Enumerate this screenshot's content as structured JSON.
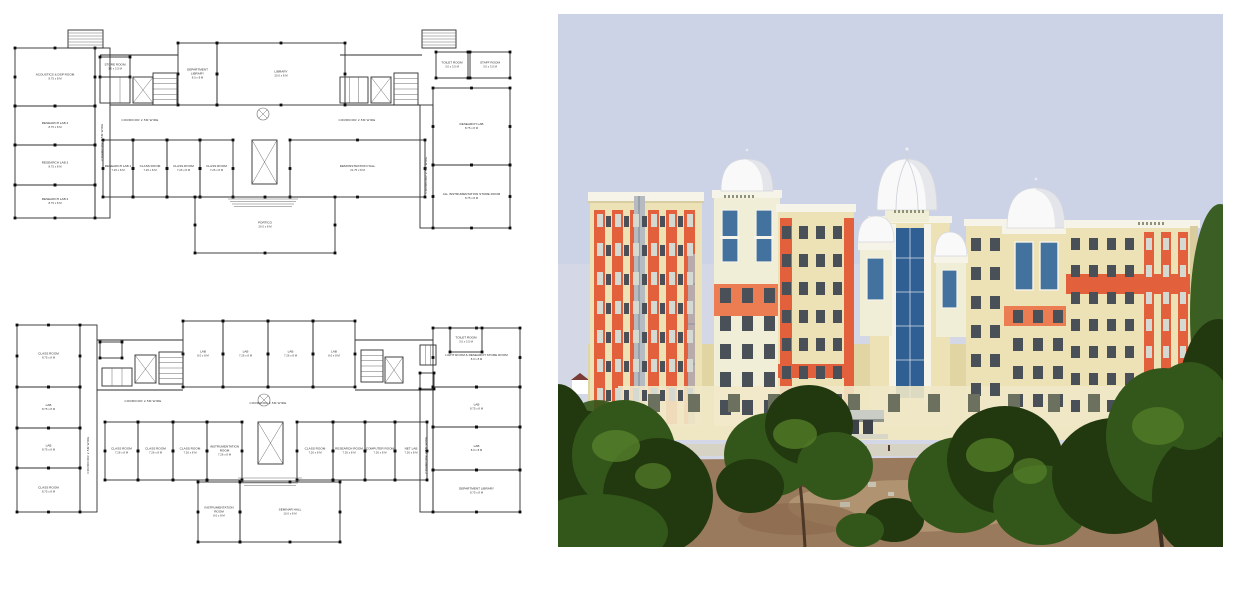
{
  "page": {
    "background": "#ffffff"
  },
  "palette": {
    "sky_top": "#cdd3e6",
    "sky_bottom": "#dadbe3",
    "wall_cream": "#ece2b6",
    "wall_cream_dark": "#e2d5a4",
    "wall_pale": "#f0eed6",
    "trim_white": "#f6f3e8",
    "accent_orange": "#e2613c",
    "accent_orange_light": "#ec7d52",
    "dome_white": "#f9f9f9",
    "dome_shade": "#c8ccd6",
    "glass_blue": "#44729f",
    "glass_blue_dark": "#2f5f93",
    "win_dark": "#4a5058",
    "win_pale": "#d4d9d2",
    "tree_dark": "#22380f",
    "tree_mid": "#33571a",
    "tree_light": "#55802a",
    "dirt": "#9a7a5c",
    "dirt_light": "#b59a77",
    "plan_wall": "#2e2e2e"
  },
  "plans": {
    "plan1": {
      "id": "first-floor-plan",
      "corridor_label": "CORRIDOR 2.5M WIDE",
      "rooms": [
        {
          "x": 15,
          "y": 48,
          "w": 80,
          "h": 58,
          "label": "ACOUSTICS & DSP ROOM",
          "dims": "8.75 x 8 M"
        },
        {
          "x": 15,
          "y": 106,
          "w": 80,
          "h": 39,
          "label": "RESEARCH LAB 4",
          "dims": "8.75 x 8 M"
        },
        {
          "x": 15,
          "y": 145,
          "w": 80,
          "h": 40,
          "label": "RESEARCH LAB 3",
          "dims": "8.75 x 8 M"
        },
        {
          "x": 15,
          "y": 185,
          "w": 80,
          "h": 33,
          "label": "RESEARCH LAB 2",
          "dims": "8.75 x 8 M"
        },
        {
          "x": 100,
          "y": 57,
          "w": 30,
          "h": 20,
          "label": "STORE ROOM",
          "dims": "3.0 x 3.5 M"
        },
        {
          "x": 178,
          "y": 43,
          "w": 39,
          "h": 62,
          "label": "DEPARTMENT LIBRARY",
          "dims": "8.0 x 8 M"
        },
        {
          "x": 217,
          "y": 43,
          "w": 128,
          "h": 62,
          "label": "LIBRARY",
          "dims": "20.0 x 8 M"
        },
        {
          "x": 436,
          "y": 52,
          "w": 32,
          "h": 26,
          "label": "TOILET ROOM",
          "dims": "3.0 x 3.5 M"
        },
        {
          "x": 470,
          "y": 52,
          "w": 40,
          "h": 26,
          "label": "STAFF ROOM",
          "dims": "3.0 x 3.5 M"
        },
        {
          "x": 433,
          "y": 88,
          "w": 77,
          "h": 77,
          "label": "RESEARCH LAB",
          "dims": "8.75 x 8 M"
        },
        {
          "x": 433,
          "y": 165,
          "w": 77,
          "h": 63,
          "label": "ALL INSTRUMENTATION STORE ROOM",
          "dims": "8.75 x 8 M"
        },
        {
          "x": 103,
          "y": 140,
          "w": 30,
          "h": 57,
          "label": "RESEARCH LAB 1",
          "dims": "7.26 x 8 M"
        },
        {
          "x": 133,
          "y": 140,
          "w": 34,
          "h": 57,
          "label": "CLASS ROOM",
          "dims": "7.26 x 8 M"
        },
        {
          "x": 167,
          "y": 140,
          "w": 33,
          "h": 57,
          "label": "CLASS ROOM",
          "dims": "7.26 x 8 M"
        },
        {
          "x": 200,
          "y": 140,
          "w": 33,
          "h": 57,
          "label": "CLASS ROOM",
          "dims": "7.26 x 8 M"
        },
        {
          "x": 290,
          "y": 140,
          "w": 135,
          "h": 57,
          "label": "DEMONSTRATION HALL",
          "dims": "21.75 x 8 M"
        },
        {
          "x": 195,
          "y": 197,
          "w": 140,
          "h": 56,
          "label": "PORTICO",
          "dims": "20.0 x 8 M"
        }
      ],
      "corridor_rects": [
        [
          95,
          48,
          15,
          170
        ],
        [
          420,
          105,
          13,
          123
        ]
      ],
      "stairs": [
        [
          68,
          30,
          35,
          18
        ],
        [
          153,
          73,
          24,
          32
        ],
        [
          394,
          73,
          24,
          32
        ],
        [
          422,
          30,
          34,
          18
        ]
      ],
      "shafts": [
        [
          133,
          77,
          20,
          26
        ],
        [
          371,
          77,
          20,
          26
        ],
        [
          252,
          140,
          25,
          44
        ]
      ],
      "toilets": [
        [
          100,
          77,
          30,
          26
        ],
        [
          340,
          77,
          28,
          26
        ]
      ],
      "steps": [
        [
          228,
          199,
          70
        ]
      ],
      "circles": [
        [
          263,
          114,
          6
        ]
      ],
      "lines": [
        [
          110,
          105,
          178,
          105
        ],
        [
          345,
          105,
          420,
          105
        ],
        [
          100,
          55,
          178,
          55
        ],
        [
          340,
          55,
          422,
          55
        ]
      ],
      "corridor_labels": [
        {
          "x": 140,
          "y": 121,
          "vertical": false
        },
        {
          "x": 357,
          "y": 121,
          "vertical": false
        },
        {
          "x": 103,
          "y": 142,
          "vertical": true
        },
        {
          "x": 427,
          "y": 175,
          "vertical": true
        }
      ]
    },
    "plan2": {
      "id": "ground-floor-plan",
      "corridor_label": "CORRIDOR 2.5M WIDE",
      "rooms": [
        {
          "x": 17,
          "y": 325,
          "w": 63,
          "h": 62,
          "label": "CLASS ROOM",
          "dims": "8.75 x 8 M"
        },
        {
          "x": 17,
          "y": 387,
          "w": 63,
          "h": 41,
          "label": "LAB",
          "dims": "8.75 x 8 M"
        },
        {
          "x": 17,
          "y": 428,
          "w": 63,
          "h": 40,
          "label": "LAB",
          "dims": "8.75 x 8 M"
        },
        {
          "x": 17,
          "y": 468,
          "w": 63,
          "h": 44,
          "label": "CLASS ROOM",
          "dims": "8.75 x 8 M"
        },
        {
          "x": 100,
          "y": 342,
          "w": 22,
          "h": 16,
          "label": "",
          "dims": ""
        },
        {
          "x": 183,
          "y": 321,
          "w": 40,
          "h": 66,
          "label": "LAB",
          "dims": "8.0 x 8 M"
        },
        {
          "x": 223,
          "y": 321,
          "w": 45,
          "h": 66,
          "label": "LAB",
          "dims": "7.26 x 8 M"
        },
        {
          "x": 268,
          "y": 321,
          "w": 45,
          "h": 66,
          "label": "LAB",
          "dims": "7.26 x 8 M"
        },
        {
          "x": 313,
          "y": 321,
          "w": 42,
          "h": 66,
          "label": "LAB",
          "dims": "8.0 x 8 M"
        },
        {
          "x": 433,
          "y": 328,
          "w": 87,
          "h": 59,
          "label": "LIGHT ROOM & RESEARCH STORE ROOM",
          "dims": "8.0 x 8 M"
        },
        {
          "x": 450,
          "y": 328,
          "w": 32,
          "h": 24,
          "label": "TOILET ROOM",
          "dims": "3.0 x 3.5 M"
        },
        {
          "x": 433,
          "y": 387,
          "w": 87,
          "h": 40,
          "label": "LAB",
          "dims": "8.75 x 8 M"
        },
        {
          "x": 433,
          "y": 427,
          "w": 87,
          "h": 43,
          "label": "LAB",
          "dims": "8.0 x 8 M"
        },
        {
          "x": 433,
          "y": 470,
          "w": 87,
          "h": 42,
          "label": "DEPARTMENT LIBRARY",
          "dims": "8.75 x 8 M"
        },
        {
          "x": 105,
          "y": 422,
          "w": 33,
          "h": 58,
          "label": "CLASS ROOM",
          "dims": "7.26 x 8 M"
        },
        {
          "x": 138,
          "y": 422,
          "w": 35,
          "h": 58,
          "label": "CLASS ROOM",
          "dims": "7.26 x 8 M"
        },
        {
          "x": 173,
          "y": 422,
          "w": 34,
          "h": 58,
          "label": "CLASS ROOM",
          "dims": "7.26 x 8 M"
        },
        {
          "x": 207,
          "y": 422,
          "w": 35,
          "h": 58,
          "label": "INSTRUMENTATION ROOM",
          "dims": "7.26 x 8 M"
        },
        {
          "x": 297,
          "y": 422,
          "w": 36,
          "h": 58,
          "label": "CLASS ROOM",
          "dims": "7.26 x 8 M"
        },
        {
          "x": 333,
          "y": 422,
          "w": 32,
          "h": 58,
          "label": "RESEARCH ROOM",
          "dims": "7.26 x 8 M"
        },
        {
          "x": 365,
          "y": 422,
          "w": 30,
          "h": 58,
          "label": "COMPUTER ROOM",
          "dims": "7.26 x 8 M"
        },
        {
          "x": 395,
          "y": 422,
          "w": 32,
          "h": 58,
          "label": "NET LAB",
          "dims": "7.26 x 8 M"
        },
        {
          "x": 198,
          "y": 482,
          "w": 42,
          "h": 60,
          "label": "INSTRUMENTATION ROOM",
          "dims": "8.0 x 8 M"
        },
        {
          "x": 240,
          "y": 482,
          "w": 100,
          "h": 60,
          "label": "SEMINAR HALL",
          "dims": "10.0 x 8 M"
        },
        {
          "x": 420,
          "y": 373,
          "w": 14,
          "h": 16,
          "label": "",
          "dims": ""
        }
      ],
      "corridor_rects": [
        [
          80,
          325,
          17,
          187
        ],
        [
          420,
          390,
          13,
          122
        ]
      ],
      "stairs": [
        [
          159,
          352,
          24,
          32
        ],
        [
          361,
          350,
          22,
          32
        ]
      ],
      "shafts": [
        [
          135,
          355,
          21,
          28
        ],
        [
          385,
          357,
          18,
          26
        ],
        [
          258,
          422,
          25,
          42
        ]
      ],
      "toilets": [
        [
          102,
          368,
          30,
          18
        ],
        [
          420,
          345,
          16,
          20
        ]
      ],
      "steps": [
        [
          238,
          478,
          64
        ]
      ],
      "circles": [
        [
          264,
          400,
          6
        ]
      ],
      "lines": [
        [
          97,
          340,
          183,
          340
        ],
        [
          355,
          340,
          433,
          340
        ],
        [
          97,
          390,
          183,
          390
        ],
        [
          355,
          390,
          420,
          390
        ]
      ],
      "corridor_labels": [
        {
          "x": 143,
          "y": 402,
          "vertical": false
        },
        {
          "x": 268,
          "y": 404,
          "vertical": false
        },
        {
          "x": 89,
          "y": 455,
          "vertical": true
        },
        {
          "x": 427,
          "y": 455,
          "vertical": true
        }
      ]
    }
  },
  "photo": {
    "window_groups": [
      {
        "x": 39,
        "y": 200,
        "cols": 6,
        "rows": 7,
        "dx": 18,
        "dy": 29,
        "w": 6,
        "h": 13,
        "fill": "win_pale"
      },
      {
        "x": 48,
        "y": 202,
        "cols": 5,
        "rows": 7,
        "dx": 18,
        "dy": 29,
        "w": 5,
        "h": 11,
        "fill": "win_dark"
      },
      {
        "x": 162,
        "y": 274,
        "cols": 3,
        "rows": 5,
        "dx": 22,
        "dy": 28,
        "w": 11,
        "h": 15,
        "fill": "win_dark"
      },
      {
        "x": 224,
        "y": 212,
        "cols": 4,
        "rows": 7,
        "dx": 17,
        "dy": 28,
        "w": 9,
        "h": 13,
        "fill": "win_dark"
      },
      {
        "x": 413,
        "y": 224,
        "cols": 2,
        "rows": 6,
        "dx": 19,
        "dy": 29,
        "w": 10,
        "h": 13,
        "fill": "win_dark"
      },
      {
        "x": 455,
        "y": 296,
        "cols": 3,
        "rows": 4,
        "dx": 20,
        "dy": 28,
        "w": 10,
        "h": 13,
        "fill": "win_dark"
      },
      {
        "x": 513,
        "y": 224,
        "cols": 4,
        "rows": 7,
        "dx": 18,
        "dy": 27,
        "w": 9,
        "h": 12,
        "fill": "win_dark"
      },
      {
        "x": 588,
        "y": 224,
        "cols": 3,
        "rows": 7,
        "dx": 17,
        "dy": 27,
        "w": 6,
        "h": 12,
        "fill": "win_pale"
      },
      {
        "x": 166,
        "y": 181,
        "cols": 8,
        "rows": 1,
        "dx": 4,
        "dy": 0,
        "w": 2,
        "h": 3,
        "fill": "#8f9178"
      },
      {
        "x": 336,
        "y": 196,
        "cols": 8,
        "rows": 1,
        "dx": 4,
        "dy": 0,
        "w": 2,
        "h": 3,
        "fill": "#8f9178"
      },
      {
        "x": 580,
        "y": 208,
        "cols": 7,
        "rows": 1,
        "dx": 4,
        "dy": 0,
        "w": 2,
        "h": 3,
        "fill": "#8f9178"
      },
      {
        "x": 90,
        "y": 380,
        "cols": 13,
        "rows": 1,
        "dx": 40,
        "dy": 0,
        "w": 12,
        "h": 18,
        "fill": "#6b705f"
      }
    ]
  }
}
